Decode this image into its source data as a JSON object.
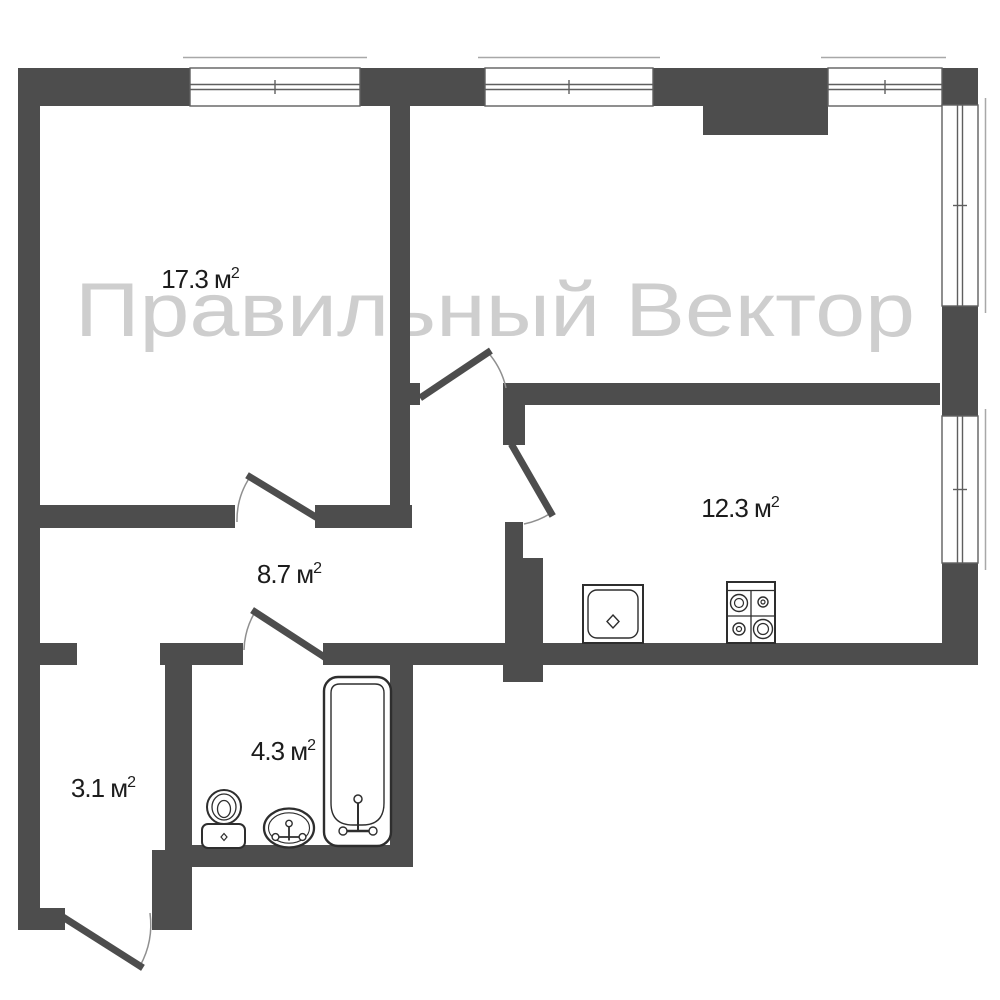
{
  "watermark": {
    "text": "Правильный Вектор",
    "color": "#c6c6c6"
  },
  "labels": {
    "bedroom": {
      "text": "17.3 м",
      "sup": "2"
    },
    "kitchen": {
      "text": "12.3 м",
      "sup": "2"
    },
    "hallway": {
      "text": "8.7 м",
      "sup": "2"
    },
    "bathroom": {
      "text": "4.3 м",
      "sup": "2"
    },
    "entry": {
      "text": "3.1 м",
      "sup": "2"
    }
  },
  "colors": {
    "wall": "#4d4d4d",
    "fixture_stroke": "#2e2e2e",
    "door_arc": "#8f8f8f",
    "window_frame": "#5f5f5f",
    "window_sill": "#a8a8a8",
    "label": "#1c1c1c",
    "watermark": "#c6c6c6",
    "background": "#ffffff"
  }
}
